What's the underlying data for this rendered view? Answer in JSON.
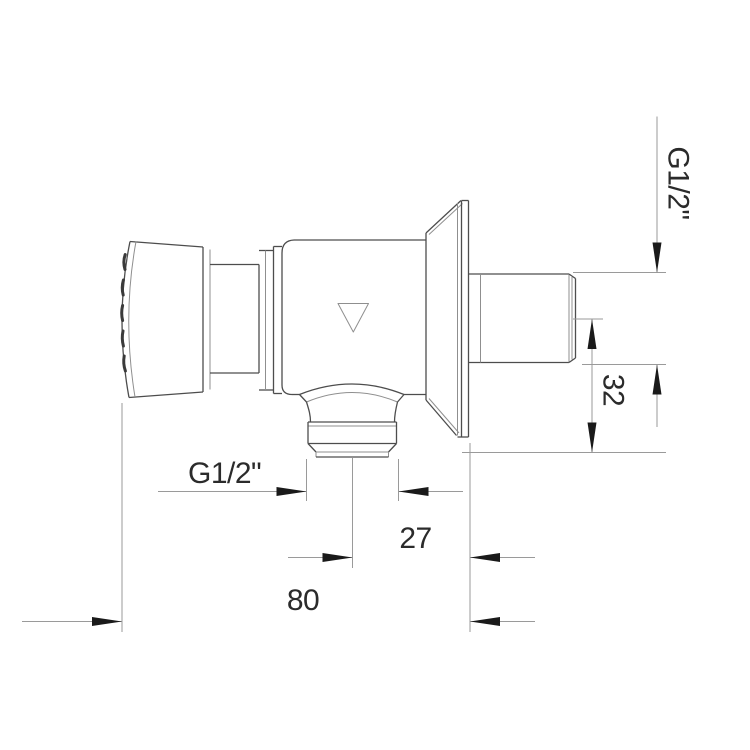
{
  "colors": {
    "background": "#ffffff",
    "object_line": "#4d4d4d",
    "detail_line": "#8f8f8f",
    "dim_line": "#9a9a9a",
    "arrow": "#1a1a1a",
    "text": "#2b2b2b"
  },
  "dimensions": {
    "side_thread_label": "G1/2\"",
    "side_axis_offset": "32",
    "bottom_thread_label": "G1/2\"",
    "outlet_axis_to_wall": "27",
    "overall_depth": "80"
  },
  "icons": {
    "flow_direction": "triangle-down-outline"
  }
}
